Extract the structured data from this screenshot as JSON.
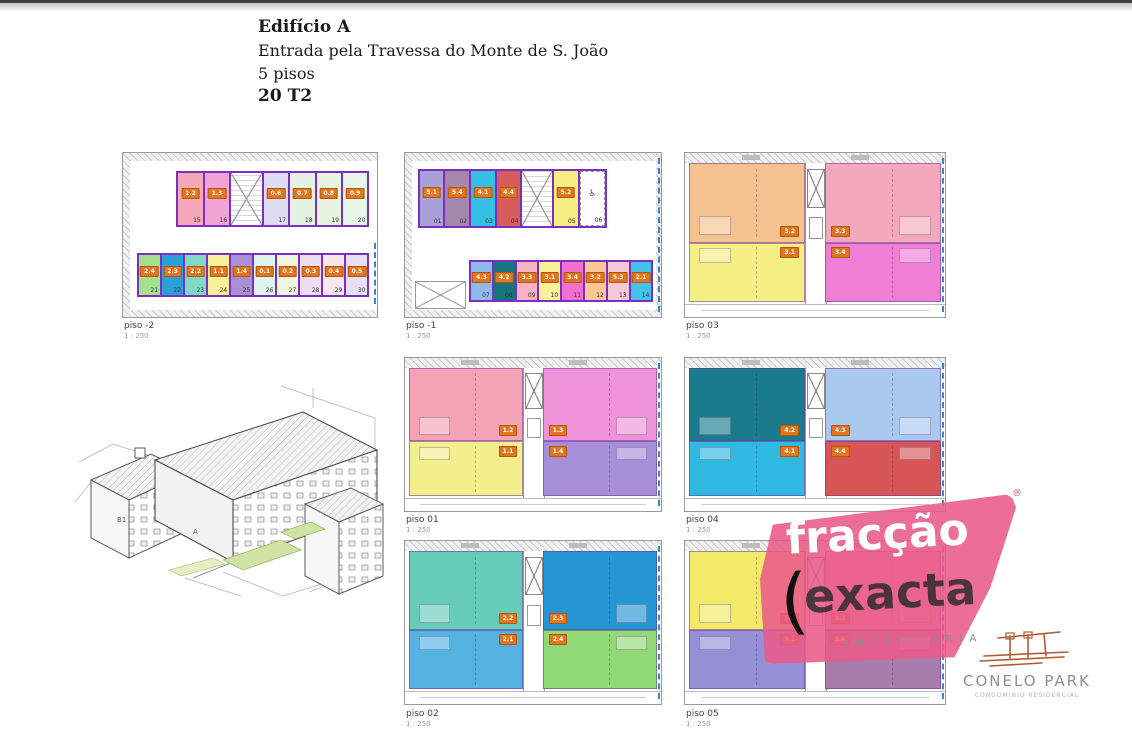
{
  "header": {
    "title": "Edifício A",
    "subtitle": "Entrada pela Travessa do Monte de S. João",
    "line3": "5 pisos",
    "line4": "20 T2"
  },
  "plans": [
    {
      "id": "piso-2",
      "label": "piso -2",
      "scale": "1 : 250",
      "type": "garage",
      "top_row": [
        {
          "unit": "1.2",
          "space": "15",
          "color": "#f5a9b8"
        },
        {
          "unit": "1.3",
          "space": "16",
          "color": "#f2a3d6"
        },
        {
          "stair": true
        },
        {
          "unit": "0.6",
          "space": "17",
          "color": "#dddcf2"
        },
        {
          "unit": "0.7",
          "space": "18",
          "color": "#e3f2e3"
        },
        {
          "unit": "0.8",
          "space": "19",
          "color": "#e7f5e0"
        },
        {
          "unit": "0.9",
          "space": "20",
          "color": "#e6f7ea"
        }
      ],
      "bottom_row": [
        {
          "unit": "2.4",
          "space": "21",
          "color": "#a5e08a"
        },
        {
          "unit": "2.3",
          "space": "22",
          "color": "#2b9fd8"
        },
        {
          "unit": "2.2",
          "space": "23",
          "color": "#7fd9c6"
        },
        {
          "unit": "1.1",
          "space": "24",
          "color": "#f7f099"
        },
        {
          "unit": "1.4",
          "space": "25",
          "color": "#a98fd6"
        },
        {
          "unit": "0.1",
          "space": "26",
          "color": "#dff5ec"
        },
        {
          "unit": "0.2",
          "space": "27",
          "color": "#eef7dd"
        },
        {
          "unit": "0.3",
          "space": "28",
          "color": "#ecdff2"
        },
        {
          "unit": "0.4",
          "space": "29",
          "color": "#f7e6ee"
        },
        {
          "unit": "0.5",
          "space": "30",
          "color": "#e7e0f4"
        }
      ]
    },
    {
      "id": "piso-1",
      "label": "piso -1",
      "scale": "1 : 250",
      "type": "garage",
      "top_row": [
        {
          "unit": "5.1",
          "space": "01",
          "color": "#a7a0d9"
        },
        {
          "unit": "5.4",
          "space": "02",
          "color": "#a587ad"
        },
        {
          "unit": "4.1",
          "space": "03",
          "color": "#35bfe5"
        },
        {
          "unit": "4.4",
          "space": "04",
          "color": "#d85c5c"
        },
        {
          "stair": true
        },
        {
          "unit": "5.2",
          "space": "05",
          "color": "#f7ee82"
        },
        {
          "accessible": true,
          "space": "06"
        }
      ],
      "bottom_row": [
        {
          "unit": "4.3",
          "space": "07",
          "color": "#8fb9e8"
        },
        {
          "unit": "4.2",
          "space": "08",
          "color": "#17737d"
        },
        {
          "unit": "3.3",
          "space": "09",
          "color": "#f8b3c3"
        },
        {
          "unit": "3.1",
          "space": "10",
          "color": "#f8f198"
        },
        {
          "unit": "3.4",
          "space": "11",
          "color": "#f070d0"
        },
        {
          "unit": "3.2",
          "space": "12",
          "color": "#f8c794"
        },
        {
          "unit": "5.3",
          "space": "13",
          "color": "#f6c9da"
        },
        {
          "unit": "2.1",
          "space": "14",
          "color": "#45c2e8"
        }
      ]
    },
    {
      "id": "piso03",
      "label": "piso 03",
      "scale": "1 : 250",
      "type": "floor",
      "units": [
        {
          "pos": "tl",
          "unit": "3.2",
          "color": "#f3c28e"
        },
        {
          "pos": "tr",
          "unit": "3.3",
          "color": "#f3a9bb"
        },
        {
          "pos": "bl",
          "unit": "3.1",
          "color": "#f5ef85"
        },
        {
          "pos": "br",
          "unit": "3.4",
          "color": "#ef7fd4"
        }
      ]
    },
    {
      "id": "piso01",
      "label": "piso 01",
      "scale": "1 : 250",
      "type": "floor",
      "units": [
        {
          "pos": "tl",
          "unit": "1.2",
          "color": "#f3a3b3"
        },
        {
          "pos": "tr",
          "unit": "1.3",
          "color": "#ee93d8"
        },
        {
          "pos": "bl",
          "unit": "1.1",
          "color": "#f3ee8e"
        },
        {
          "pos": "br",
          "unit": "1.4",
          "color": "#a78fd8"
        }
      ]
    },
    {
      "id": "piso04",
      "label": "piso 04",
      "scale": "1 : 250",
      "type": "floor",
      "units": [
        {
          "pos": "tl",
          "unit": "4.2",
          "color": "#1a7b8c"
        },
        {
          "pos": "tr",
          "unit": "4.3",
          "color": "#a9c9ee"
        },
        {
          "pos": "bl",
          "unit": "4.1",
          "color": "#30b9e0"
        },
        {
          "pos": "br",
          "unit": "4.4",
          "color": "#d65656"
        }
      ]
    },
    {
      "id": "piso02",
      "label": "piso 02",
      "scale": "1 : 250",
      "type": "floor",
      "units": [
        {
          "pos": "tl",
          "unit": "2.2",
          "color": "#66cbb9"
        },
        {
          "pos": "tr",
          "unit": "2.3",
          "color": "#2496d2"
        },
        {
          "pos": "bl",
          "unit": "2.1",
          "color": "#55b3e2"
        },
        {
          "pos": "br",
          "unit": "2.4",
          "color": "#8fda74"
        }
      ]
    },
    {
      "id": "piso05",
      "label": "piso 05",
      "scale": "1 : 250",
      "type": "floor",
      "units": [
        {
          "pos": "tl",
          "unit": "5.2",
          "color": "#f2e969"
        },
        {
          "pos": "tr",
          "unit": "5.3",
          "color": "#f2a9c6"
        },
        {
          "pos": "bl",
          "unit": "5.1",
          "color": "#958fd6"
        },
        {
          "pos": "br",
          "unit": "5.4",
          "color": "#a87cab"
        }
      ]
    }
  ],
  "axonometric": {
    "building_label": "B1",
    "block_label": "A"
  },
  "watermark": {
    "word1": "fracção",
    "word2": "exacta",
    "paren": "(",
    "registered": "®",
    "tagline": "IMOBILIÁRIA"
  },
  "logo": {
    "title": "CONELO PARK",
    "subtitle": "CONDOMÍNIO RESIDENCIAL"
  },
  "colors": {
    "badge": "#e2751f",
    "wall": "#7b2fbe",
    "boundary": "#1d6fc0",
    "watermark_pink": "#e95a89",
    "logo_rust": "#b05a33"
  }
}
